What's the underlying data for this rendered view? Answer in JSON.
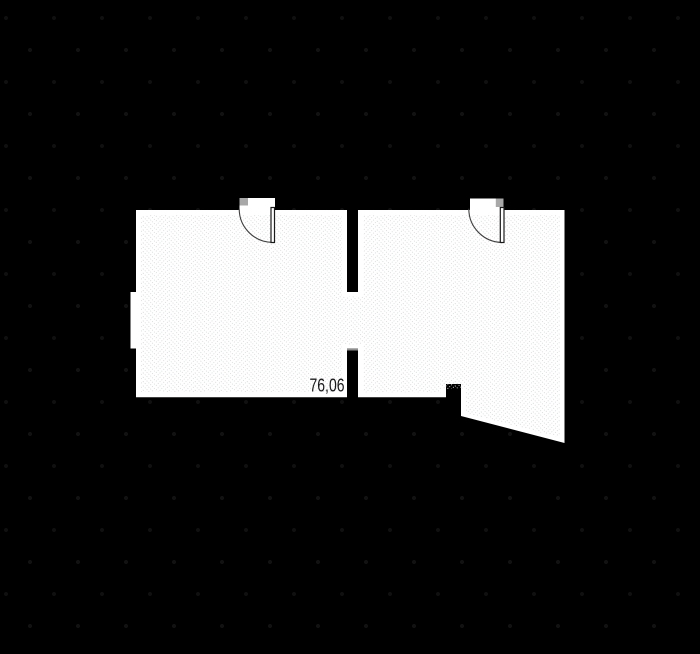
{
  "floorplan": {
    "area_label": "76,06",
    "colors": {
      "background": "#000000",
      "floor_fill": "#ffffff",
      "pattern_line": "#d6d8da",
      "door_marker": "#a8a8a8",
      "door_leaf_stroke": "#1a1a1a",
      "door_arc": "#3f3f3f",
      "threshold": "#8f8f8f",
      "label_text": "#1b1b1d"
    }
  }
}
